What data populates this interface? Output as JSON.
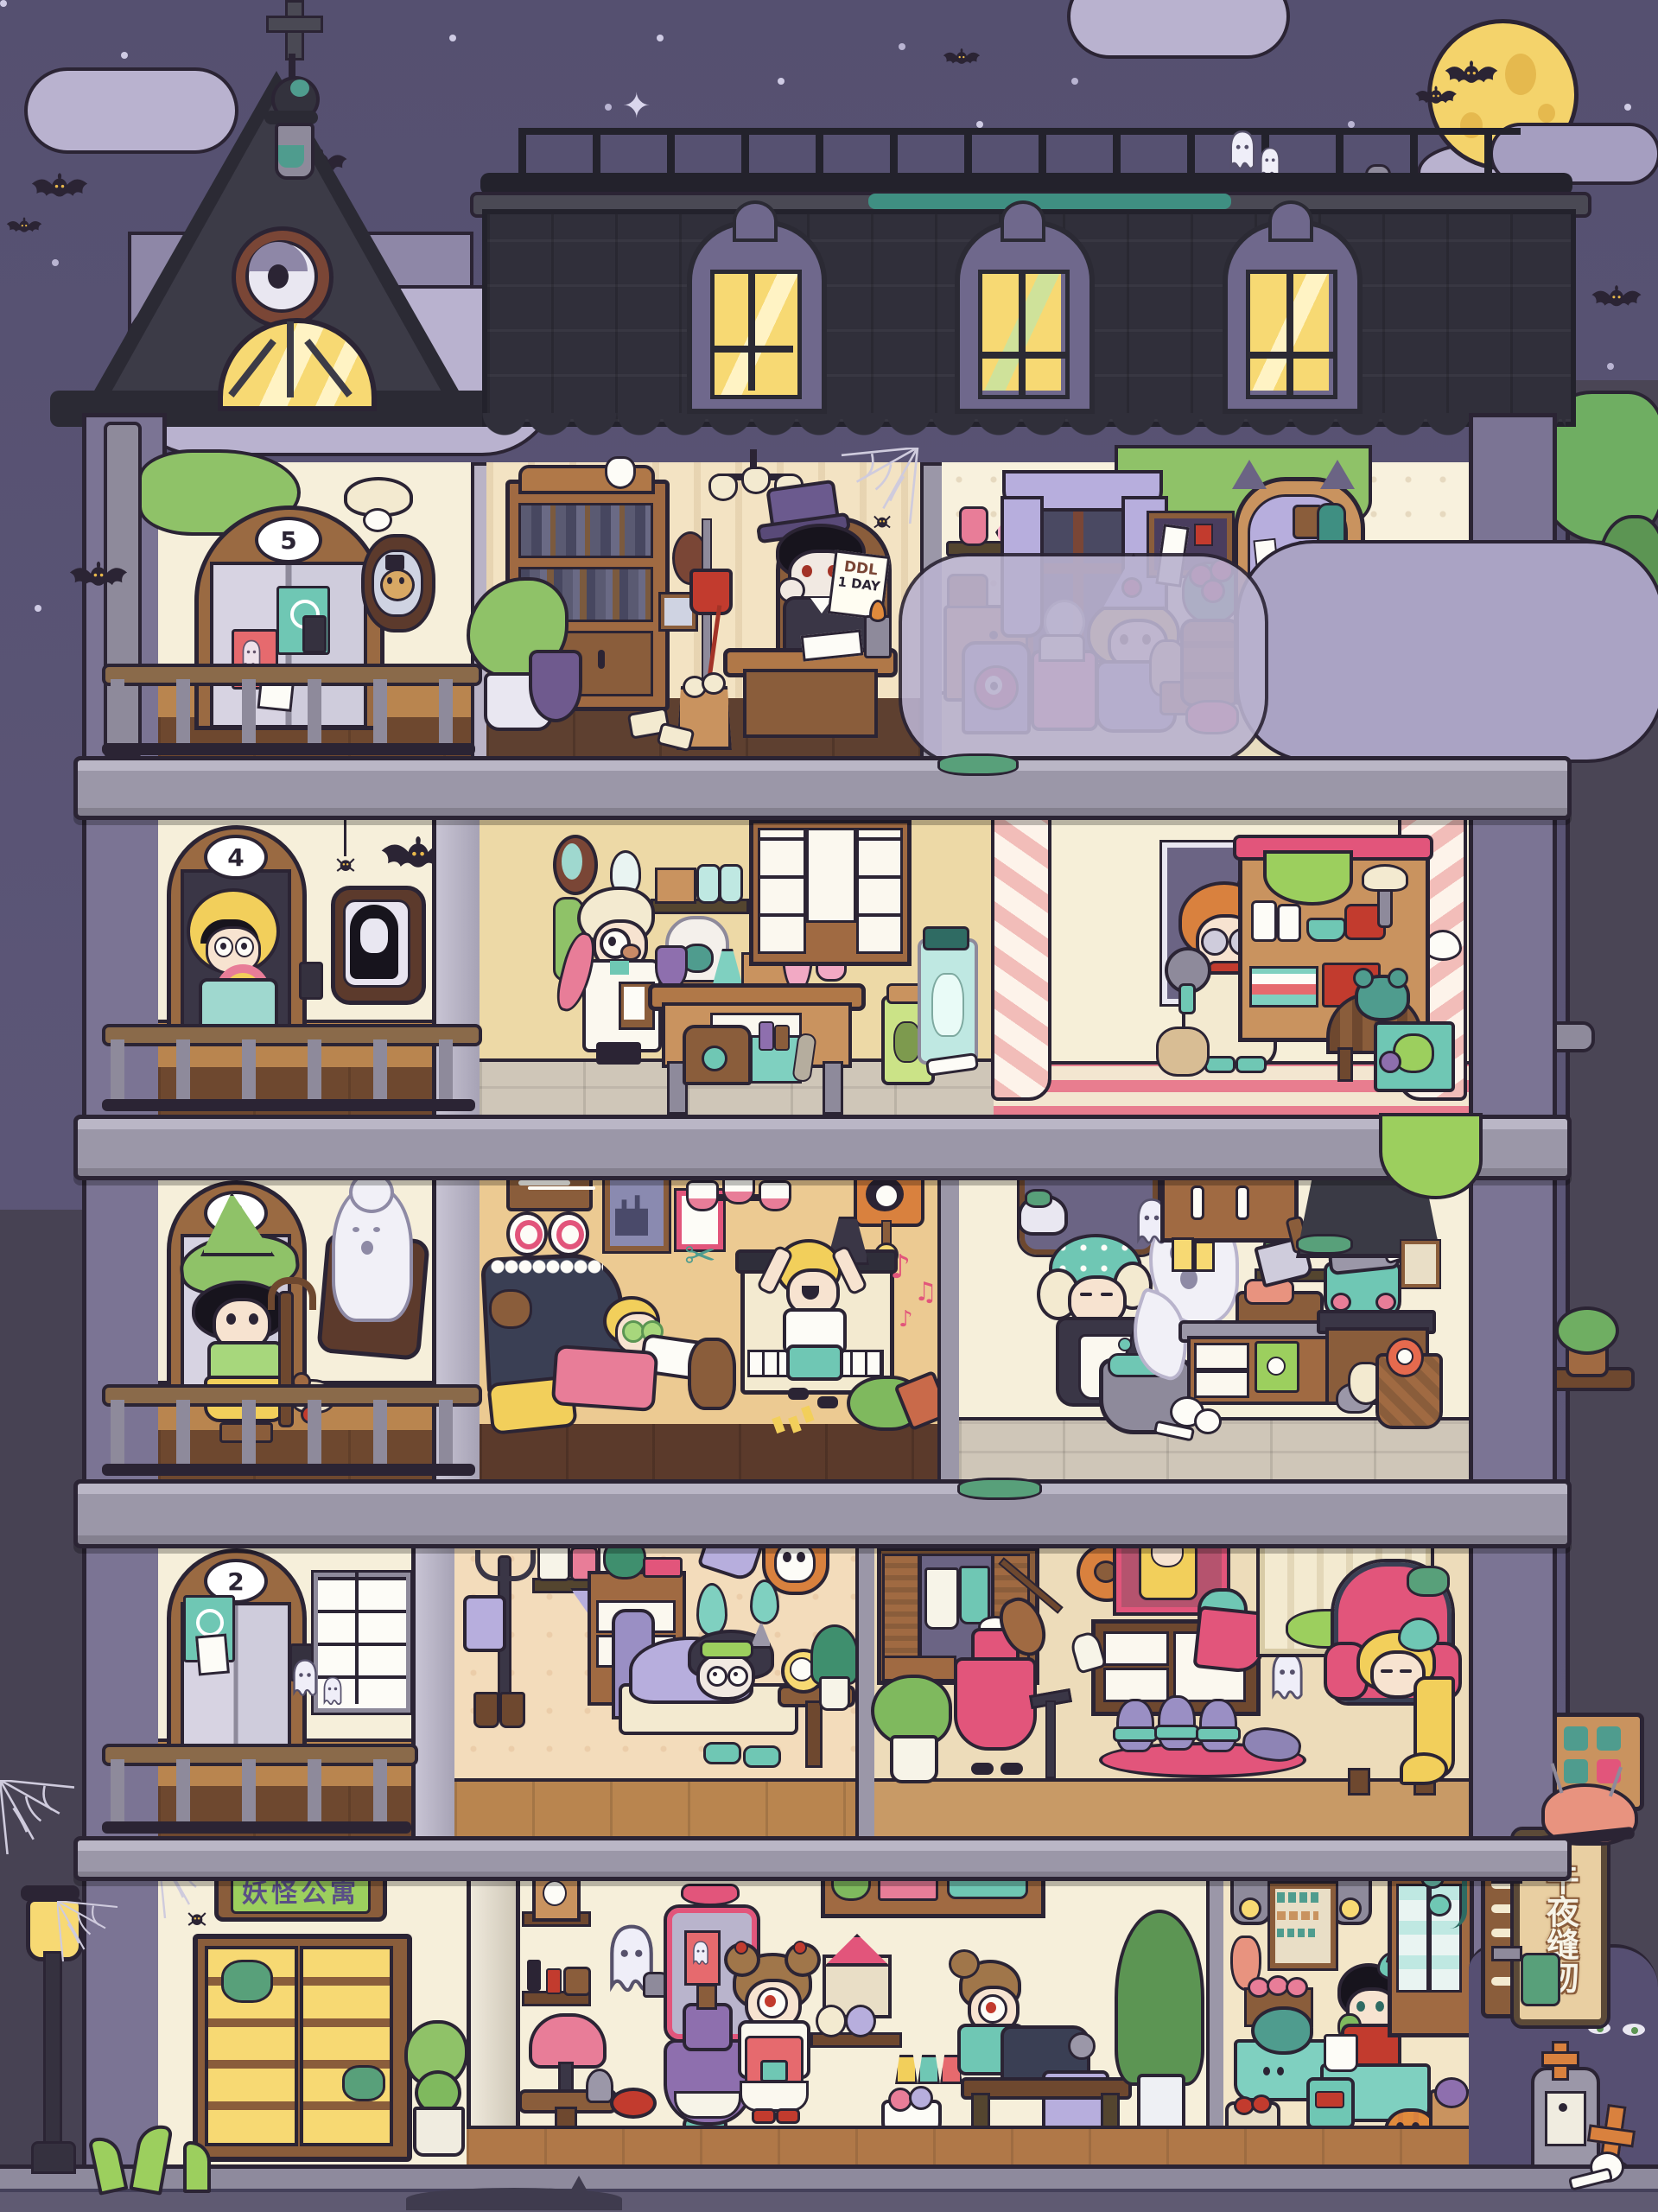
{
  "scene": {
    "type": "haunted-apartment-dollhouse-night-scene",
    "building_name_sign": "妖怪公寓",
    "vertical_shop_sign": "午夜缝纫"
  },
  "signs": {
    "floor5": "5",
    "floor4": "4",
    "floor3": "3",
    "floor2": "2",
    "ddl_line1": "DDL",
    "ddl_line2": "1 DAY",
    "entrance": "妖怪公寓",
    "midnight_sewing": "午夜缝纫"
  },
  "floors": [
    {
      "number": "5",
      "hallway": [
        "elevator",
        "skull-number-sign",
        "teal-poster",
        "red-poster",
        "crying-bear-portrait",
        "intercom",
        "hanging-bat",
        "mushroom-ceiling-lamp",
        "drain-pipe"
      ],
      "rooms": [
        {
          "name": "vampire-study",
          "characters": [
            "vampire-boy-in-top-hat"
          ],
          "objects": [
            "bookcase",
            "tooth-ornament",
            "potted-plant",
            "potion-burner",
            "blood-iv-drip",
            "oval-portrait",
            "wall-mirror",
            "chandelier",
            "spider-web",
            "writing-desk",
            "ddl-note",
            "candle",
            "quill",
            "wastebasket",
            "crumpled-papers"
          ]
        },
        {
          "name": "doll-witch-bedroom",
          "characters": [
            "blonde-witch-girl-sewing-voodoo-doll"
          ],
          "objects": [
            "potion-shelf",
            "pink-crystal",
            "cabinet",
            "bell-jar-heart",
            "window-purple-curtains",
            "eyeball-chair",
            "cake-trolley",
            "skull-crystal-ball",
            "corkboard",
            "rose-bouquet",
            "barrel",
            "cat-ear-cabinet",
            "fishbowl",
            "skull-chest",
            "parrot-on-stand",
            "ceiling-moss"
          ]
        }
      ]
    },
    {
      "number": "4",
      "hallway": [
        "elevator",
        "skull-number-sign",
        "scared-girl-with-donut",
        "ghost-girl-portrait",
        "spider-on-thread",
        "bat",
        "intercom"
      ],
      "rooms": [
        {
          "name": "alchemy-lab",
          "characters": [
            "old-scientist-with-clipboard",
            "pink-tentacle"
          ],
          "objects": [
            "oval-mirror",
            "wall-bulb-lamp",
            "potion-shelf",
            "test-tube-rack",
            "bell-jar-cat-specimen",
            "purple-flask",
            "teal-flask",
            "pink-distiller",
            "coil-condenser",
            "lab-bench",
            "drawer-cabinet",
            "chest",
            "potion-crate",
            "specimen-jar-green-creature",
            "specimen-jar-bunny",
            "bones"
          ]
        },
        {
          "name": "monster-nursery",
          "characters": [
            "dizzy-girl-with-rattle"
          ],
          "objects": [
            "pink-striped-curtains",
            "window",
            "shelf-with-baby-bottles",
            "shower-arm",
            "slime-drip",
            "folded-clothes",
            "round-crib",
            "teal-teddy",
            "toy-box",
            "voodoo-doll"
          ]
        }
      ]
    },
    {
      "number": "3",
      "hallway": [
        "elevator",
        "skull-number-sign",
        "green-hat-witch-with-staff",
        "grandma-ghost-portrait",
        "puppy"
      ],
      "rooms": [
        {
          "name": "living-room",
          "characters": [
            "kid-on-sofa-cucumber-eyes",
            "kid-jumping-at-piano"
          ],
          "objects": [
            "fishbone-frame",
            "wall-plates",
            "castle-painting",
            "pink-frame",
            "chandelier",
            "scissors-decor",
            "monster-cuckoo-clock",
            "sofa",
            "teddy-bear",
            "yellow-pillow",
            "pink-blanket",
            "upright-piano",
            "metronome",
            "music-notes",
            "fallen-potted-plant"
          ]
        },
        {
          "name": "witch-kitchen",
          "characters": [
            "grandma-witch-cooking",
            "cauldron-ghost",
            "small-ghost",
            "rat-with-sack"
          ],
          "objects": [
            "arched-window",
            "hanging-lamp",
            "cauldron",
            "upper-cabinets",
            "talismans",
            "cleaver-chopping-meat",
            "spice-shelf",
            "counter",
            "skull-towel",
            "stove-pot-with-mushrooms",
            "range-hood",
            "certificate",
            "vegetable-basket-eye-carrot",
            "floor-skulls"
          ]
        }
      ]
    },
    {
      "number": "2",
      "hallway": [
        "elevator",
        "skull-number-sign",
        "teal-poster",
        "mailboxes",
        "intercom",
        "little-ghosts"
      ],
      "rooms": [
        {
          "name": "insomniac-bedroom",
          "characters": [
            "sleepless-horned-kid",
            "will-o-wisps"
          ],
          "objects": [
            "trident-coat-rack",
            "hanging-bag",
            "jar-shelf",
            "cat-pennant",
            "broom",
            "horned-skull-trophy",
            "dresser",
            "camera",
            "berry-tray",
            "bed",
            "sleep-mask",
            "slippers",
            "nightstand",
            "alarm-clock",
            "fern-plant",
            "boots",
            "socks",
            "towel-stool"
          ]
        },
        {
          "name": "dressing-room",
          "characters": [
            "headless-violinist-in-pink-dress",
            "dancing-mice",
            "mouse-ghost",
            "sleeping-longhair-girl"
          ],
          "objects": [
            "wardrobe-with-dresses",
            "plant",
            "music-stand",
            "flower-lamp",
            "girl-portrait",
            "skull-lamp",
            "dresser-with-blanket",
            "white-glove",
            "pink-rug",
            "shutter-window",
            "pink-wingback-armchair"
          ]
        }
      ]
    },
    {
      "number": "1",
      "hallway": [],
      "rooms": [
        {
          "name": "entrance-lobby",
          "characters": [],
          "objects": [
            "spider-web",
            "name-plaque",
            "double-glass-doors",
            "topiaries"
          ]
        },
        {
          "name": "beauty-corner",
          "characters": [
            "ghost-maid-with-dryer"
          ],
          "objects": [
            "photo-shelf",
            "cosmetics-shelf",
            "incense",
            "fringe-lamp-table",
            "hand-mirror",
            "red-stool"
          ]
        },
        {
          "name": "sewing-atelier",
          "characters": [
            "cyclops-girl-dressing-mannequin",
            "cyclops-seamstress-at-machine"
          ],
          "objects": [
            "salon-mirror",
            "ghost-card",
            "victorian-dress-mannequin",
            "supply-shelf",
            "dollhouse-box",
            "swirl-plates",
            "potion-cabinet",
            "thread-cones",
            "yarn-bowl",
            "sewing-machine",
            "purple-fabric",
            "work-table",
            "tall-plant",
            "hanging-bag"
          ]
        },
        {
          "name": "midnight-grocery",
          "characters": [
            "bow-boy-eating-greens"
          ],
          "objects": [
            "hanging-lanterns",
            "price-board",
            "teal-poster",
            "hanging-ham",
            "radish-tier",
            "grape-stand",
            "herb-bunch",
            "cabbage-table-with-eyes",
            "sack-and-tomato-basket",
            "lemons",
            "counter",
            "sprout-bucket",
            "teal-bag",
            "jar-cabinet",
            "tomato-vine",
            "jack-o-lantern-pumpkin",
            "purple-cabbage-basket",
            "grinder"
          ]
        }
      ]
    }
  ],
  "exterior": {
    "sky": [
      "stars",
      "sparkles",
      "clouds",
      "full-moon",
      "bats"
    ],
    "tower": [
      "cross-finial",
      "orb-finial",
      "eye-ornament",
      "arched-lit-window"
    ],
    "roof": [
      "iron-railing",
      "railing-ghosts",
      "tombstone-finials",
      "dormer-windows",
      "scalloped-shingles"
    ],
    "right_tree": [
      "leaf-canopy",
      "black-cat-green-eyes",
      "mushroom-pipe-branch",
      "plant-platform",
      "hanging-glyph-sign"
    ],
    "street": [
      "street-lamp",
      "spider-webs",
      "sewer-tentacles",
      "black-cat-shadow",
      "bone-menu-board",
      "brain-pincushion",
      "tombstone-with-face",
      "orange-cross-grave",
      "bush-eyes",
      "skull-and-bones"
    ]
  },
  "colors": {
    "sky": "#5a5477",
    "moon": "#f4d36b",
    "roof": "#302f3a",
    "slab": "#9b97a8",
    "wall_cream": "#f6efda",
    "wood": "#a06a42",
    "wood_dark": "#6e482f",
    "accent_pink": "#e2557b",
    "lavender": "#b7aedd",
    "teal": "#6fc7b4",
    "leaf_green": "#8fc268",
    "lit_window": "#f7d973",
    "outline": "#2b2434"
  }
}
